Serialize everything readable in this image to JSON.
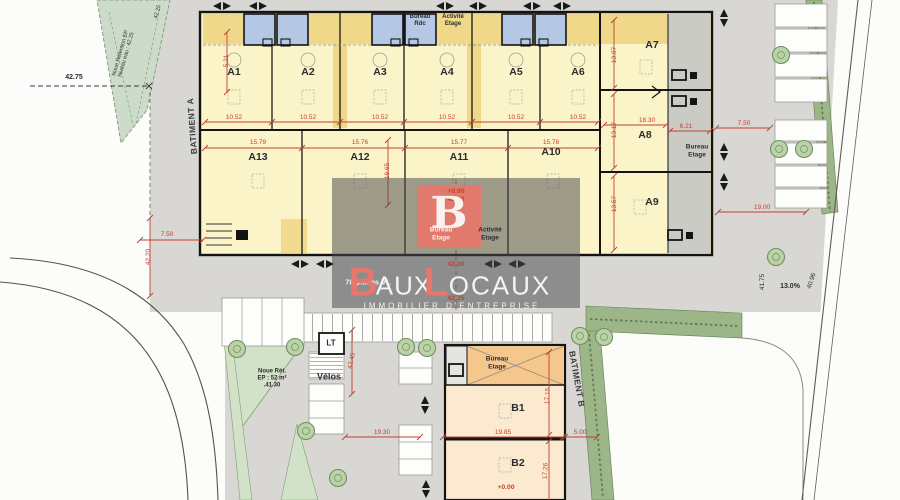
{
  "meta": {
    "title": "Plan de masse - parc d'activites",
    "width": 900,
    "height": 500
  },
  "palette": {
    "accent_salmon": "#E8766A",
    "dim_red": "#C2402F",
    "building_yellow": "#FCF4C9",
    "mezzanine_yellow": "#EFD88A",
    "office_blue": "#B4C8E5",
    "hedge_green": "#9DB687",
    "noue_green": "#CDDCCA",
    "paving_gray": "#D8D7D3",
    "orange_band": "#F6C78C"
  },
  "watermark": {
    "logo_letter": "B",
    "brand": "BAUXLOCAUX",
    "tagline": "IMMOBILIER D'ENTREPRISE"
  },
  "buildings": {
    "a": {
      "label": "BATIMENT A",
      "units_top": [
        "A1",
        "A2",
        "A3",
        "A4",
        "A5",
        "A6"
      ],
      "units_bottom": [
        "A13",
        "A12",
        "A11",
        "A10"
      ],
      "units_right": [
        "A7",
        "A8",
        "A9"
      ]
    },
    "b": {
      "label": "BATIMENT B",
      "units": [
        "B1",
        "B2"
      ]
    }
  },
  "labels": [
    {
      "t": "A1",
      "x": 234,
      "y": 72,
      "s": 10.5,
      "w": 1,
      "n": "unit-label-a1"
    },
    {
      "t": "A2",
      "x": 308,
      "y": 72,
      "s": 10.5,
      "w": 1,
      "n": "unit-label-a2"
    },
    {
      "t": "A3",
      "x": 380,
      "y": 72,
      "s": 10.5,
      "w": 1,
      "n": "unit-label-a3"
    },
    {
      "t": "A4",
      "x": 447,
      "y": 72,
      "s": 10.5,
      "w": 1,
      "n": "unit-label-a4"
    },
    {
      "t": "A5",
      "x": 516,
      "y": 72,
      "s": 10.5,
      "w": 1,
      "n": "unit-label-a5"
    },
    {
      "t": "A6",
      "x": 578,
      "y": 72,
      "s": 10.5,
      "w": 1,
      "n": "unit-label-a6"
    },
    {
      "t": "A7",
      "x": 652,
      "y": 45,
      "s": 10.5,
      "w": 1,
      "n": "unit-label-a7"
    },
    {
      "t": "A8",
      "x": 645,
      "y": 135,
      "s": 10.5,
      "w": 1,
      "n": "unit-label-a8"
    },
    {
      "t": "A9",
      "x": 652,
      "y": 202,
      "s": 10.5,
      "w": 1,
      "n": "unit-label-a9"
    },
    {
      "t": "A13",
      "x": 258,
      "y": 157,
      "s": 10.5,
      "w": 1,
      "n": "unit-label-a13"
    },
    {
      "t": "A12",
      "x": 360,
      "y": 157,
      "s": 10.5,
      "w": 1,
      "n": "unit-label-a12"
    },
    {
      "t": "A11",
      "x": 459,
      "y": 157,
      "s": 10.5,
      "w": 1,
      "n": "unit-label-a11"
    },
    {
      "t": "A10",
      "x": 551,
      "y": 152,
      "s": 10.5,
      "w": 1,
      "n": "unit-label-a10"
    },
    {
      "t": "B1",
      "x": 518,
      "y": 408,
      "s": 10.5,
      "w": 1,
      "n": "unit-label-b1"
    },
    {
      "t": "B2",
      "x": 518,
      "y": 463,
      "s": 10.5,
      "w": 1,
      "n": "unit-label-b2"
    },
    {
      "t": "Bureau\nRdc",
      "x": 420,
      "y": 21,
      "s": 6,
      "w": 1,
      "n": "mezz-label-bureau-rdc"
    },
    {
      "t": "Activité\nEtage",
      "x": 453,
      "y": 21,
      "s": 6,
      "w": 1,
      "n": "mezz-label-activite-etage"
    },
    {
      "t": "Bureau\nEtage",
      "x": 697,
      "y": 151,
      "s": 6.5,
      "w": 1,
      "n": "label-bureau-etage-right"
    },
    {
      "t": "Bureau\nEtage",
      "x": 441,
      "y": 234,
      "s": 6.5,
      "w": 1,
      "c": "white",
      "n": "label-bureau-etage-center"
    },
    {
      "t": "Activité\nEtage",
      "x": 490,
      "y": 234,
      "s": 6.5,
      "w": 1,
      "n": "label-activite-etage-center"
    },
    {
      "t": "Bureau\nEtage",
      "x": 497,
      "y": 363,
      "s": 6.5,
      "w": 1,
      "n": "label-bureau-etage-b"
    },
    {
      "t": "LT",
      "x": 331,
      "y": 343,
      "s": 8,
      "w": 1,
      "n": "label-lt"
    },
    {
      "t": "Vélos",
      "x": 329,
      "y": 377,
      "s": 9,
      "w": 1,
      "n": "label-velos"
    },
    {
      "t": "Noue Rét.\nEP : 52 m²\n.41.30",
      "x": 272,
      "y": 379,
      "s": 6,
      "w": 1,
      "n": "label-noue-retention-sw"
    },
    {
      "t": "Noue Rétention EP\nNiveau eau : 42.25",
      "x": 124,
      "y": 54,
      "r": -74,
      "s": 5.5,
      "n": "label-noue-retention-nw"
    },
    {
      "t": "42.25",
      "x": 158,
      "y": 12,
      "r": -74,
      "s": 5.5,
      "n": "level-42-25-corner"
    },
    {
      "t": "BATIMENT A",
      "x": 192,
      "y": 126,
      "r": -94,
      "s": 8.5,
      "w": 1,
      "ls": 0.5,
      "c": "gray",
      "n": "label-batiment-a"
    },
    {
      "t": "BATIMENT B",
      "x": 577,
      "y": 379,
      "r": 80,
      "s": 8.5,
      "w": 1,
      "ls": 0.5,
      "c": "gray",
      "n": "label-batiment-b"
    },
    {
      "t": "42.75",
      "x": 74,
      "y": 78,
      "s": 7,
      "w": 1,
      "n": "level-42-75"
    },
    {
      "t": "41.75",
      "x": 763,
      "y": 282,
      "r": -90,
      "s": 6.5,
      "n": "level-41-75"
    },
    {
      "t": "13.0%",
      "x": 790,
      "y": 287,
      "s": 7,
      "w": 1,
      "n": "ramp-slope-13pct"
    },
    {
      "t": "40.96",
      "x": 812,
      "y": 281,
      "r": -72,
      "s": 6.5,
      "n": "level-40-96"
    },
    {
      "t": "10.52",
      "x": 234,
      "y": 118,
      "s": 6.5,
      "c": "red",
      "n": "dim-a1"
    },
    {
      "t": "10.52",
      "x": 308,
      "y": 118,
      "s": 6.5,
      "c": "red",
      "n": "dim-a2"
    },
    {
      "t": "10.52",
      "x": 380,
      "y": 118,
      "s": 6.5,
      "c": "red",
      "n": "dim-a3"
    },
    {
      "t": "10.52",
      "x": 447,
      "y": 118,
      "s": 6.5,
      "c": "red",
      "n": "dim-a4"
    },
    {
      "t": "10.52",
      "x": 516,
      "y": 118,
      "s": 6.5,
      "c": "red",
      "n": "dim-a5"
    },
    {
      "t": "10.52",
      "x": 578,
      "y": 118,
      "s": 6.5,
      "c": "red",
      "n": "dim-a6"
    },
    {
      "t": "15.79",
      "x": 258,
      "y": 143,
      "s": 6.5,
      "c": "red",
      "n": "dim-a13"
    },
    {
      "t": "15.76",
      "x": 360,
      "y": 143,
      "s": 6.5,
      "c": "red",
      "n": "dim-a12"
    },
    {
      "t": "15.77",
      "x": 459,
      "y": 143,
      "s": 6.5,
      "c": "red",
      "n": "dim-a11"
    },
    {
      "t": "15.78",
      "x": 551,
      "y": 143,
      "s": 6.5,
      "c": "red",
      "n": "dim-a10"
    },
    {
      "t": "5.21",
      "x": 227,
      "y": 61,
      "r": -90,
      "s": 6.5,
      "c": "red",
      "n": "dim-5-21"
    },
    {
      "t": "19.65",
      "x": 388,
      "y": 171,
      "r": -90,
      "s": 6.5,
      "c": "red",
      "n": "dim-19-65"
    },
    {
      "t": "13.07",
      "x": 615,
      "y": 55,
      "r": -90,
      "s": 6.5,
      "c": "red",
      "n": "dim-a7-depth"
    },
    {
      "t": "13.17",
      "x": 615,
      "y": 130,
      "r": -90,
      "s": 6.5,
      "c": "red",
      "n": "dim-a8-depth"
    },
    {
      "t": "13.57",
      "x": 615,
      "y": 204,
      "r": -90,
      "s": 6.5,
      "c": "red",
      "n": "dim-a9-depth"
    },
    {
      "t": "18.30",
      "x": 647,
      "y": 121,
      "s": 6.5,
      "c": "red",
      "n": "dim-18-30"
    },
    {
      "t": "6.21",
      "x": 686,
      "y": 127,
      "s": 6.5,
      "c": "red",
      "n": "dim-6-21"
    },
    {
      "t": "7.50",
      "x": 744,
      "y": 124,
      "s": 6.5,
      "c": "red",
      "n": "dim-7-50-right"
    },
    {
      "t": "19.00",
      "x": 762,
      "y": 208,
      "s": 6.5,
      "c": "red",
      "n": "dim-19-00"
    },
    {
      "t": "7.50",
      "x": 167,
      "y": 235,
      "s": 6.5,
      "c": "red",
      "n": "dim-7-50-left"
    },
    {
      "t": "42.20",
      "x": 149,
      "y": 257,
      "r": -90,
      "s": 6.5,
      "c": "red",
      "n": "dim-42-20"
    },
    {
      "t": "42.45",
      "x": 352,
      "y": 361,
      "r": -78,
      "s": 6.5,
      "c": "red",
      "n": "dim-42-45"
    },
    {
      "t": "19.30",
      "x": 382,
      "y": 433,
      "s": 6.5,
      "c": "red",
      "n": "dim-19-30"
    },
    {
      "t": "19.85",
      "x": 503,
      "y": 433,
      "s": 6.5,
      "c": "red",
      "n": "dim-19-85"
    },
    {
      "t": "5.00",
      "x": 580,
      "y": 433,
      "s": 6.5,
      "c": "red",
      "n": "dim-5-00"
    },
    {
      "t": "17.15",
      "x": 548,
      "y": 396,
      "r": -87,
      "s": 6.5,
      "c": "red",
      "n": "dim-b1-depth"
    },
    {
      "t": "17.26",
      "x": 546,
      "y": 471,
      "r": -87,
      "s": 6.5,
      "c": "red",
      "n": "dim-b2-depth"
    },
    {
      "t": "+0.00\n42.00",
      "x": 456,
      "y": 196,
      "s": 6.8,
      "w": 1,
      "c": "red",
      "n": "level-a-entry"
    },
    {
      "t": "42.00",
      "x": 456,
      "y": 265,
      "s": 6.8,
      "w": 1,
      "c": "red",
      "n": "level-42-00"
    },
    {
      "t": "42.25",
      "x": 456,
      "y": 299,
      "s": 6.8,
      "w": 1,
      "c": "red",
      "n": "level-42-25"
    },
    {
      "t": "+0.00",
      "x": 506,
      "y": 488,
      "s": 6.8,
      "w": 1,
      "c": "red",
      "n": "level-b-entry"
    },
    {
      "t": "78 places VL",
      "x": 368,
      "y": 283,
      "s": 7.5,
      "w": 1,
      "c": "white",
      "n": "label-parking-count"
    },
    {
      "t": "B",
      "x": 449,
      "y": 214,
      "s": 44,
      "w": 1,
      "c": "white",
      "f": "serif",
      "n": "watermark-logo-letter"
    },
    {
      "t": "B",
      "x": 363,
      "y": 283,
      "s": 40,
      "w": 1,
      "c": "salmon",
      "n": "brand-letter-b"
    },
    {
      "t": "AUX",
      "x": 404,
      "y": 286,
      "s": 26,
      "ls": 1,
      "c": "white",
      "n": "brand-aux"
    },
    {
      "t": "L",
      "x": 436,
      "y": 283,
      "s": 40,
      "w": 1,
      "c": "salmon",
      "n": "brand-letter-l"
    },
    {
      "t": "OCAUX",
      "x": 500,
      "y": 286,
      "s": 26,
      "ls": 2,
      "c": "white",
      "n": "brand-ocaux"
    },
    {
      "t": "IMMOBILIER D'ENTREPRISE",
      "x": 452,
      "y": 306,
      "s": 8,
      "ls": 3,
      "c": "white",
      "n": "watermark-tagline"
    }
  ]
}
